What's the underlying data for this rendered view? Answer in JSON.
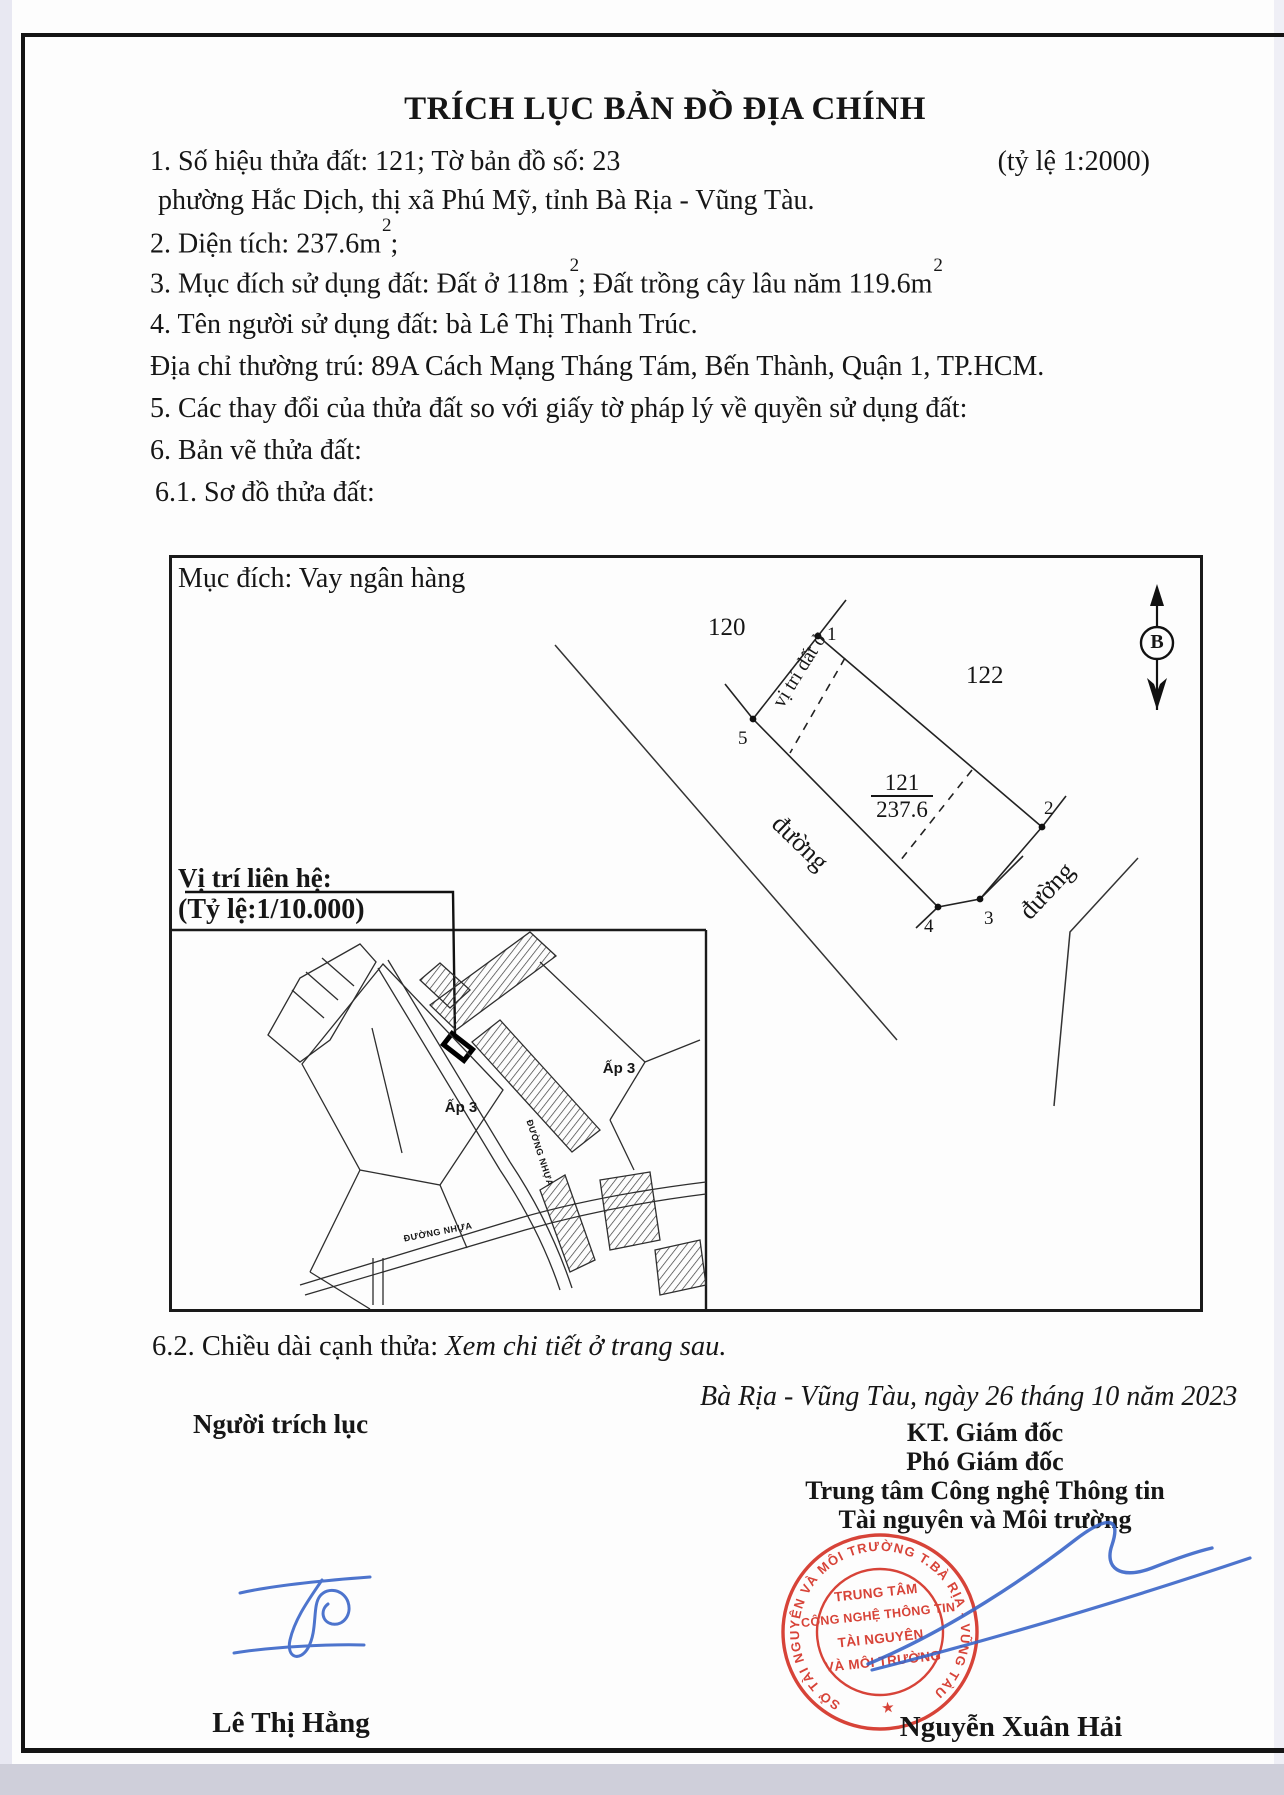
{
  "document": {
    "title": "TRÍCH LỤC BẢN ĐỒ ĐỊA CHÍNH",
    "scale_note": "(tỷ lệ 1:2000)",
    "line1": "1. Số hiệu thửa đất: 121; Tờ bản đồ số: 23",
    "line1b": "phường Hắc Dịch, thị xã Phú Mỹ, tỉnh Bà Rịa - Vũng Tàu.",
    "line2_pre": "2. Diện tích: 237.6m",
    "sup": "2",
    "line2_post": ";",
    "line3_pre": "3. Mục đích sử dụng đất: Đất ở 118m",
    "line3_mid": "; Đất trồng cây lâu năm 119.6m",
    "line4": "4. Tên người sử dụng đất: bà Lê Thị Thanh Trúc.",
    "line4b": "Địa chỉ thường trú: 89A Cách Mạng Tháng Tám, Bến Thành, Quận 1, TP.HCM.",
    "line5": "5. Các thay đổi của thửa đất so với giấy tờ pháp lý về quyền sử dụng đất:",
    "line6": "6. Bản vẽ thửa đất:",
    "line61": "6.1. Sơ đồ thửa đất:",
    "line62_label": "6.2. Chiều dài cạnh thửa: ",
    "line62_note": "Xem chi tiết ở trang sau."
  },
  "sketch": {
    "purpose": "Mục đích: Vay ngân hàng",
    "neighbor_left": "120",
    "neighbor_right": "122",
    "parcel_number": "121",
    "parcel_area": "237.6",
    "land_position_label": "vị trí đất ở",
    "road_label_1": "đường",
    "road_label_2": "đường",
    "north_letter": "B",
    "vertices": [
      "1",
      "2",
      "3",
      "4",
      "5"
    ]
  },
  "location_map": {
    "heading1": "Vị trí liên hệ:",
    "heading2": "(Tỷ lệ:1/10.000)",
    "hamlet1": "Ấp 3",
    "hamlet2": "Ấp 3",
    "road1": "ĐƯỜNG NHỰA",
    "road2": "ĐƯỜNG NHỰA"
  },
  "signing": {
    "place_date": "Bà Rịa - Vũng Tàu, ngày 26 tháng 10 năm 2023",
    "left_role": "Người trích lục",
    "left_name": "Lê Thị Hằng",
    "right_role1": "KT. Giám đốc",
    "right_role2": "Phó Giám đốc",
    "right_org1": "Trung tâm Công nghệ Thông tin",
    "right_org2": "Tài nguyên và Môi trường",
    "right_name": "Nguyễn Xuân Hải"
  },
  "stamp": {
    "ring_text": "SỞ TÀI NGUYÊN VÀ MÔI TRƯỜNG T.BÀ RỊA - VŨNG TÀU",
    "star": "★",
    "line1": "TRUNG TÂM",
    "line2": "CÔNG NGHỆ THÔNG TIN",
    "line3": "TÀI NGUYÊN",
    "line4": "VÀ MÔI TRƯỜNG"
  },
  "colors": {
    "stamp_red": "#d5352a",
    "signature_blue": "#3a66c8",
    "ink": "#161616"
  }
}
